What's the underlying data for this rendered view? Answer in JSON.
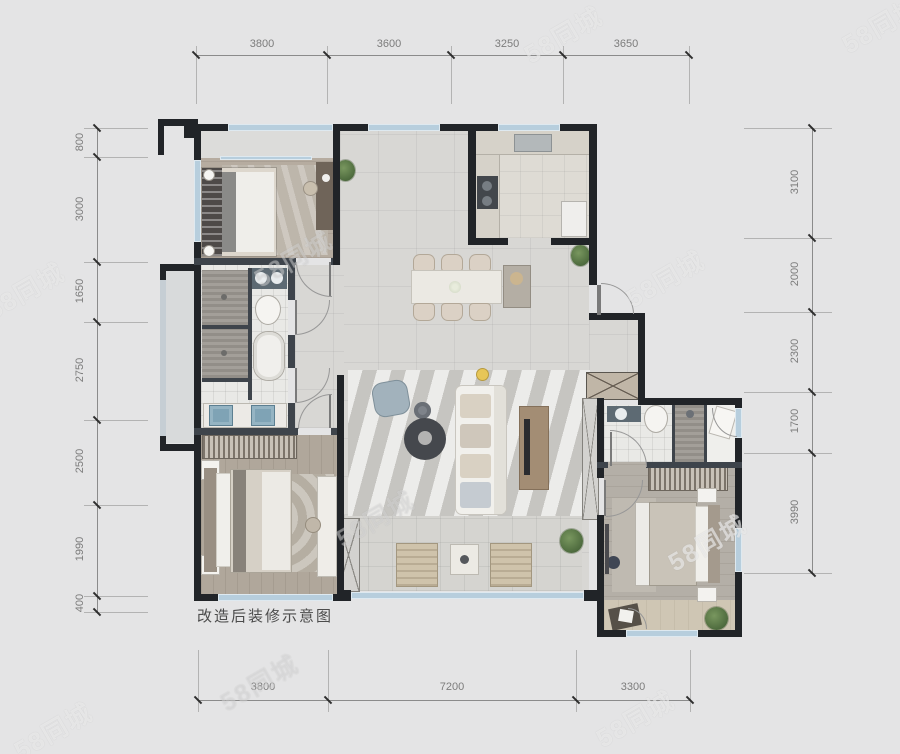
{
  "caption": "改造后装修示意图",
  "watermark": {
    "text": "58同城"
  },
  "dimensions": {
    "top": [
      "3800",
      "3600",
      "3250",
      "3650"
    ],
    "bottom": [
      "3800",
      "7200",
      "3300"
    ],
    "left": [
      "800",
      "3000",
      "1650",
      "2750",
      "2500",
      "1990",
      "400"
    ],
    "right": [
      "3100",
      "2000",
      "2300",
      "1700",
      "3990"
    ]
  },
  "colors": {
    "wall": "#212428",
    "window": "#b7cedd",
    "dimension_text": "#7c7c7c",
    "background": "#e4e4e5",
    "plant": "#5e7f4d"
  }
}
